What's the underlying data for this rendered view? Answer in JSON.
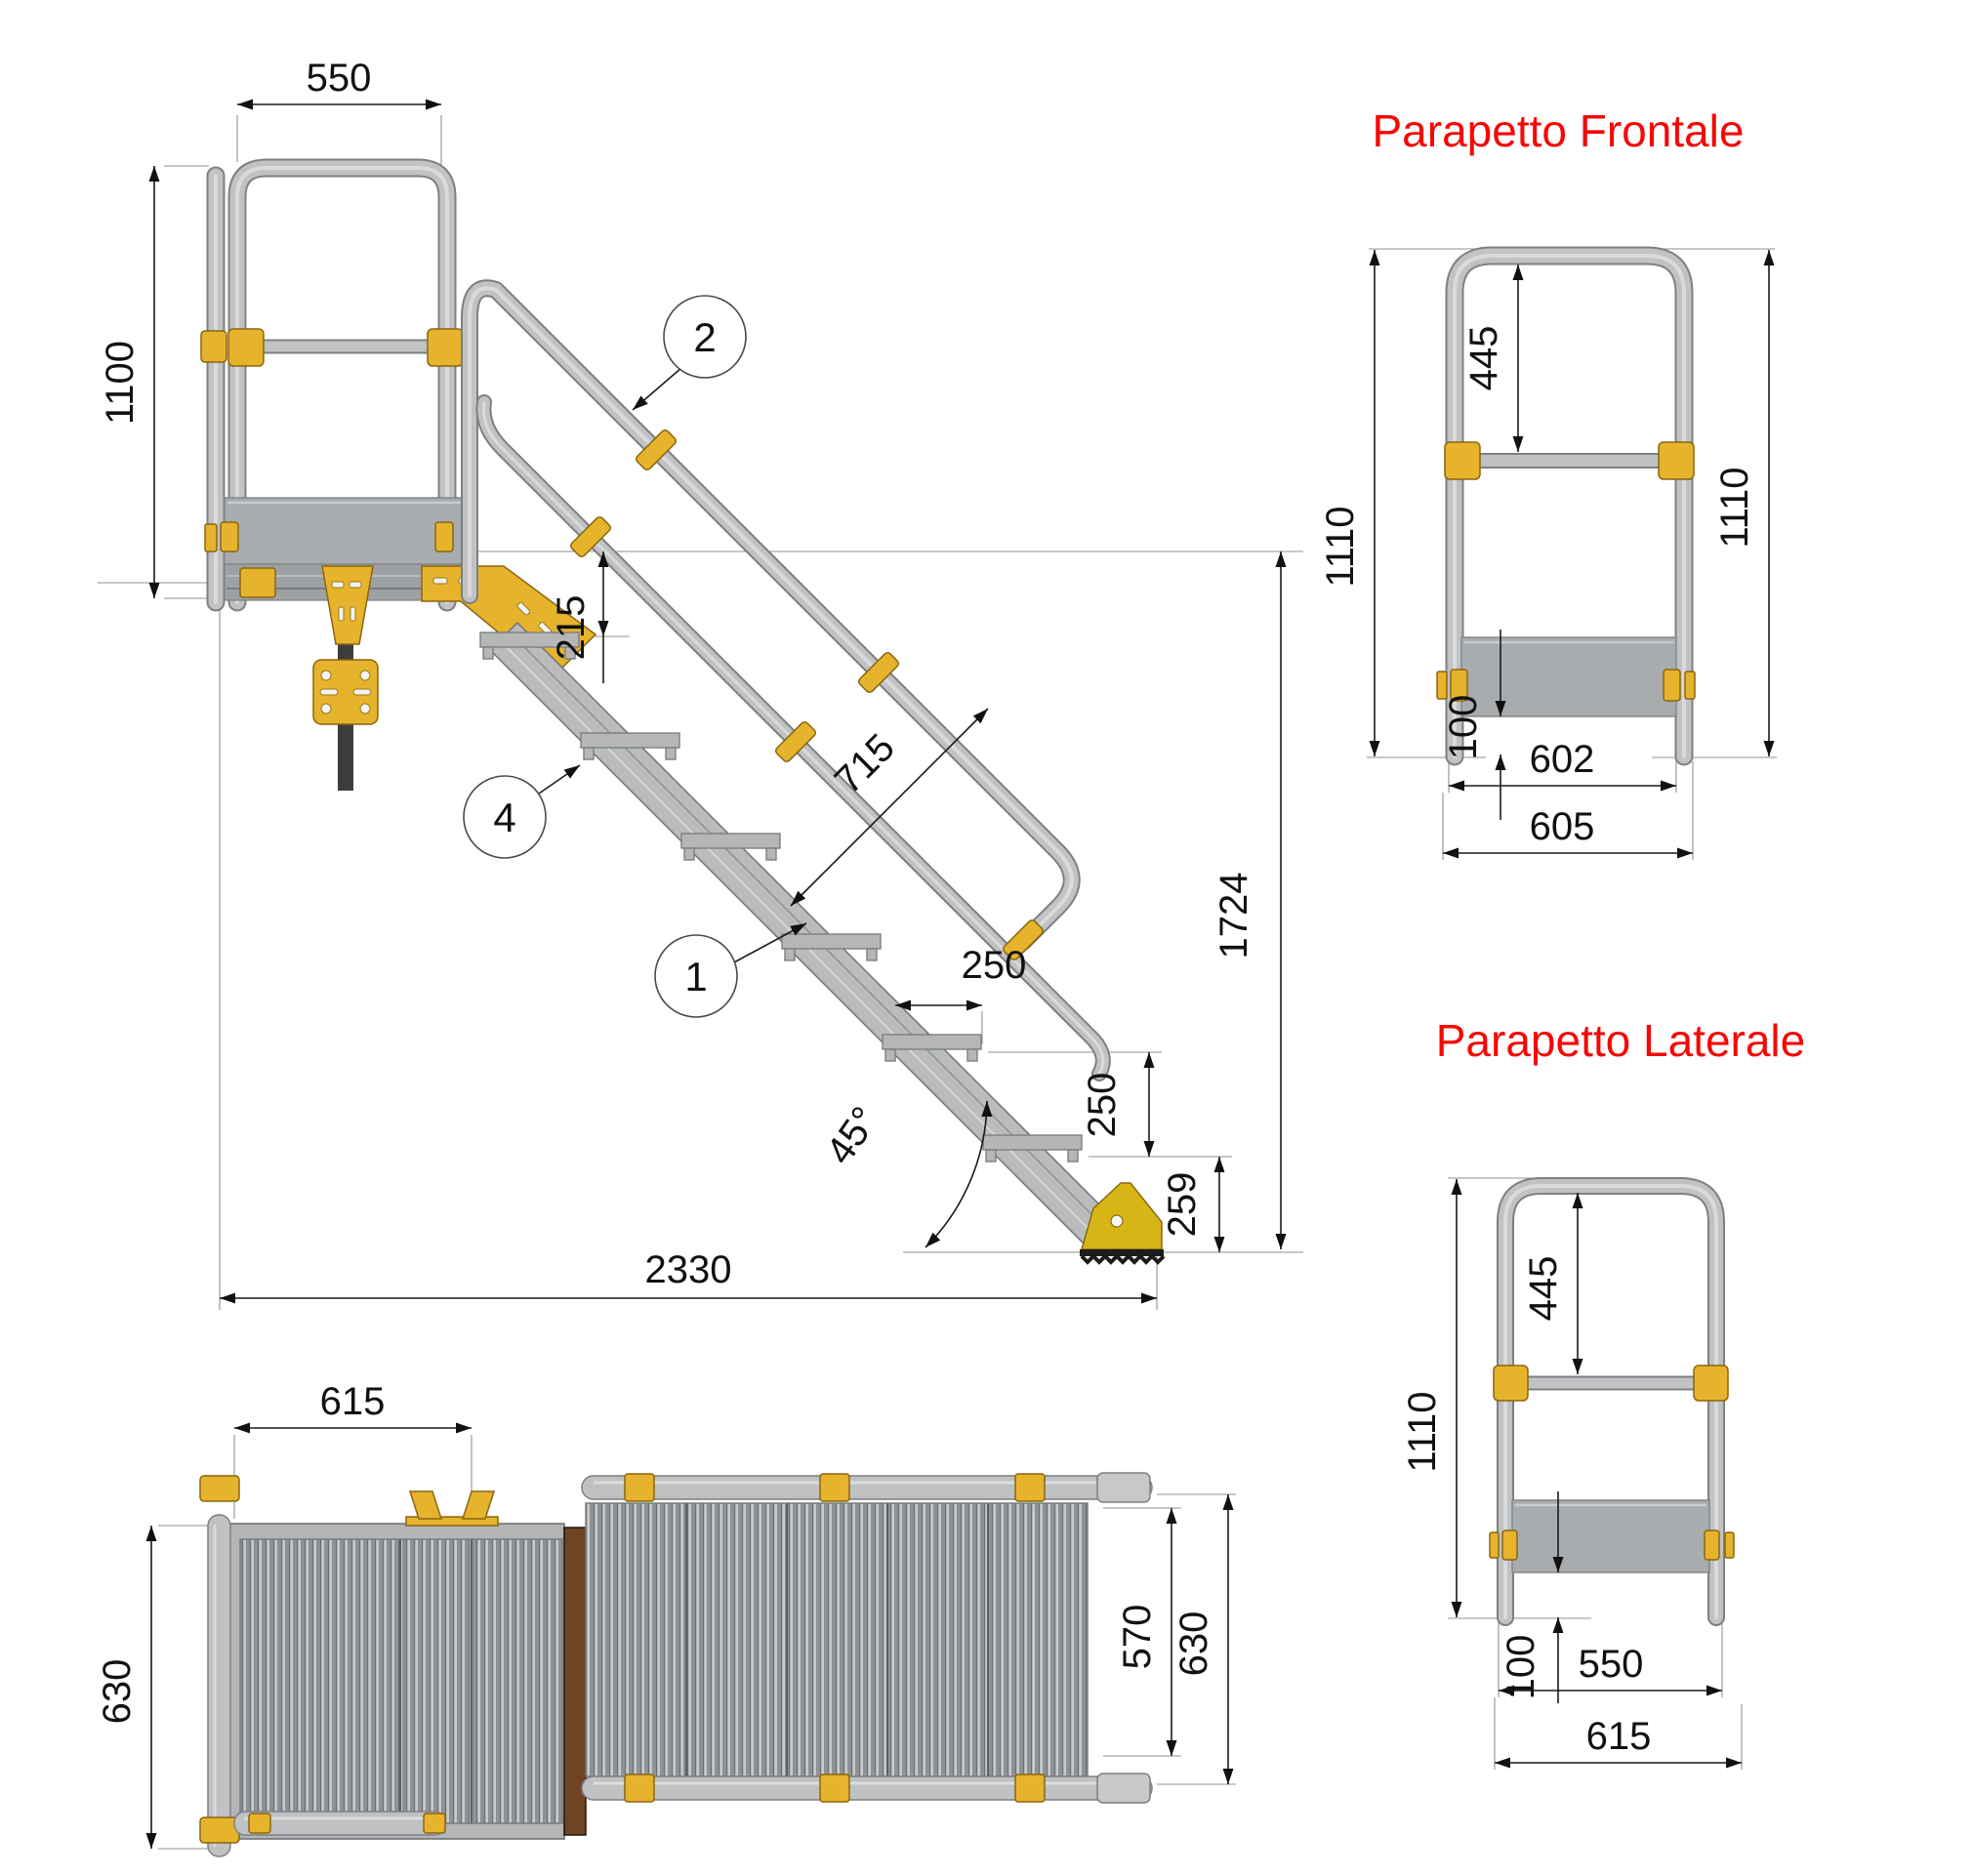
{
  "colors": {
    "accent_yellow": "#e6b32c",
    "tube_gray": "#c0c2c4",
    "panel_gray": "#a9acae",
    "title_red": "#f50806",
    "toe_brown": "#6e4425",
    "dark_bar": "#3b3d3f"
  },
  "side_view": {
    "callouts": {
      "handrail": "2",
      "stringer": "1",
      "tread": "4"
    },
    "dims": {
      "platform_rail_width": "550",
      "rail_height": "1100",
      "first_step_drop": "215",
      "handrail_offset": "715",
      "going": "250",
      "rise": "250",
      "end_height": "259",
      "angle": "45°",
      "overall_length": "2330",
      "overall_height": "1724"
    }
  },
  "front_parapet": {
    "title": "Parapetto Frontale",
    "dims": {
      "rail_to_midrail": "445",
      "height_left": "1110",
      "height_right": "1110",
      "toeboard_drop": "100",
      "width_inner": "602",
      "width_outer": "605"
    }
  },
  "side_parapet": {
    "title": "Parapetto Laterale",
    "dims": {
      "rail_to_midrail": "445",
      "height": "1110",
      "toeboard_drop": "100",
      "width_inner": "550",
      "width_outer": "615"
    }
  },
  "plan_view": {
    "dims": {
      "platform_length": "615",
      "platform_width": "630",
      "stair_width_inner": "570",
      "stair_width_outer": "630"
    }
  }
}
